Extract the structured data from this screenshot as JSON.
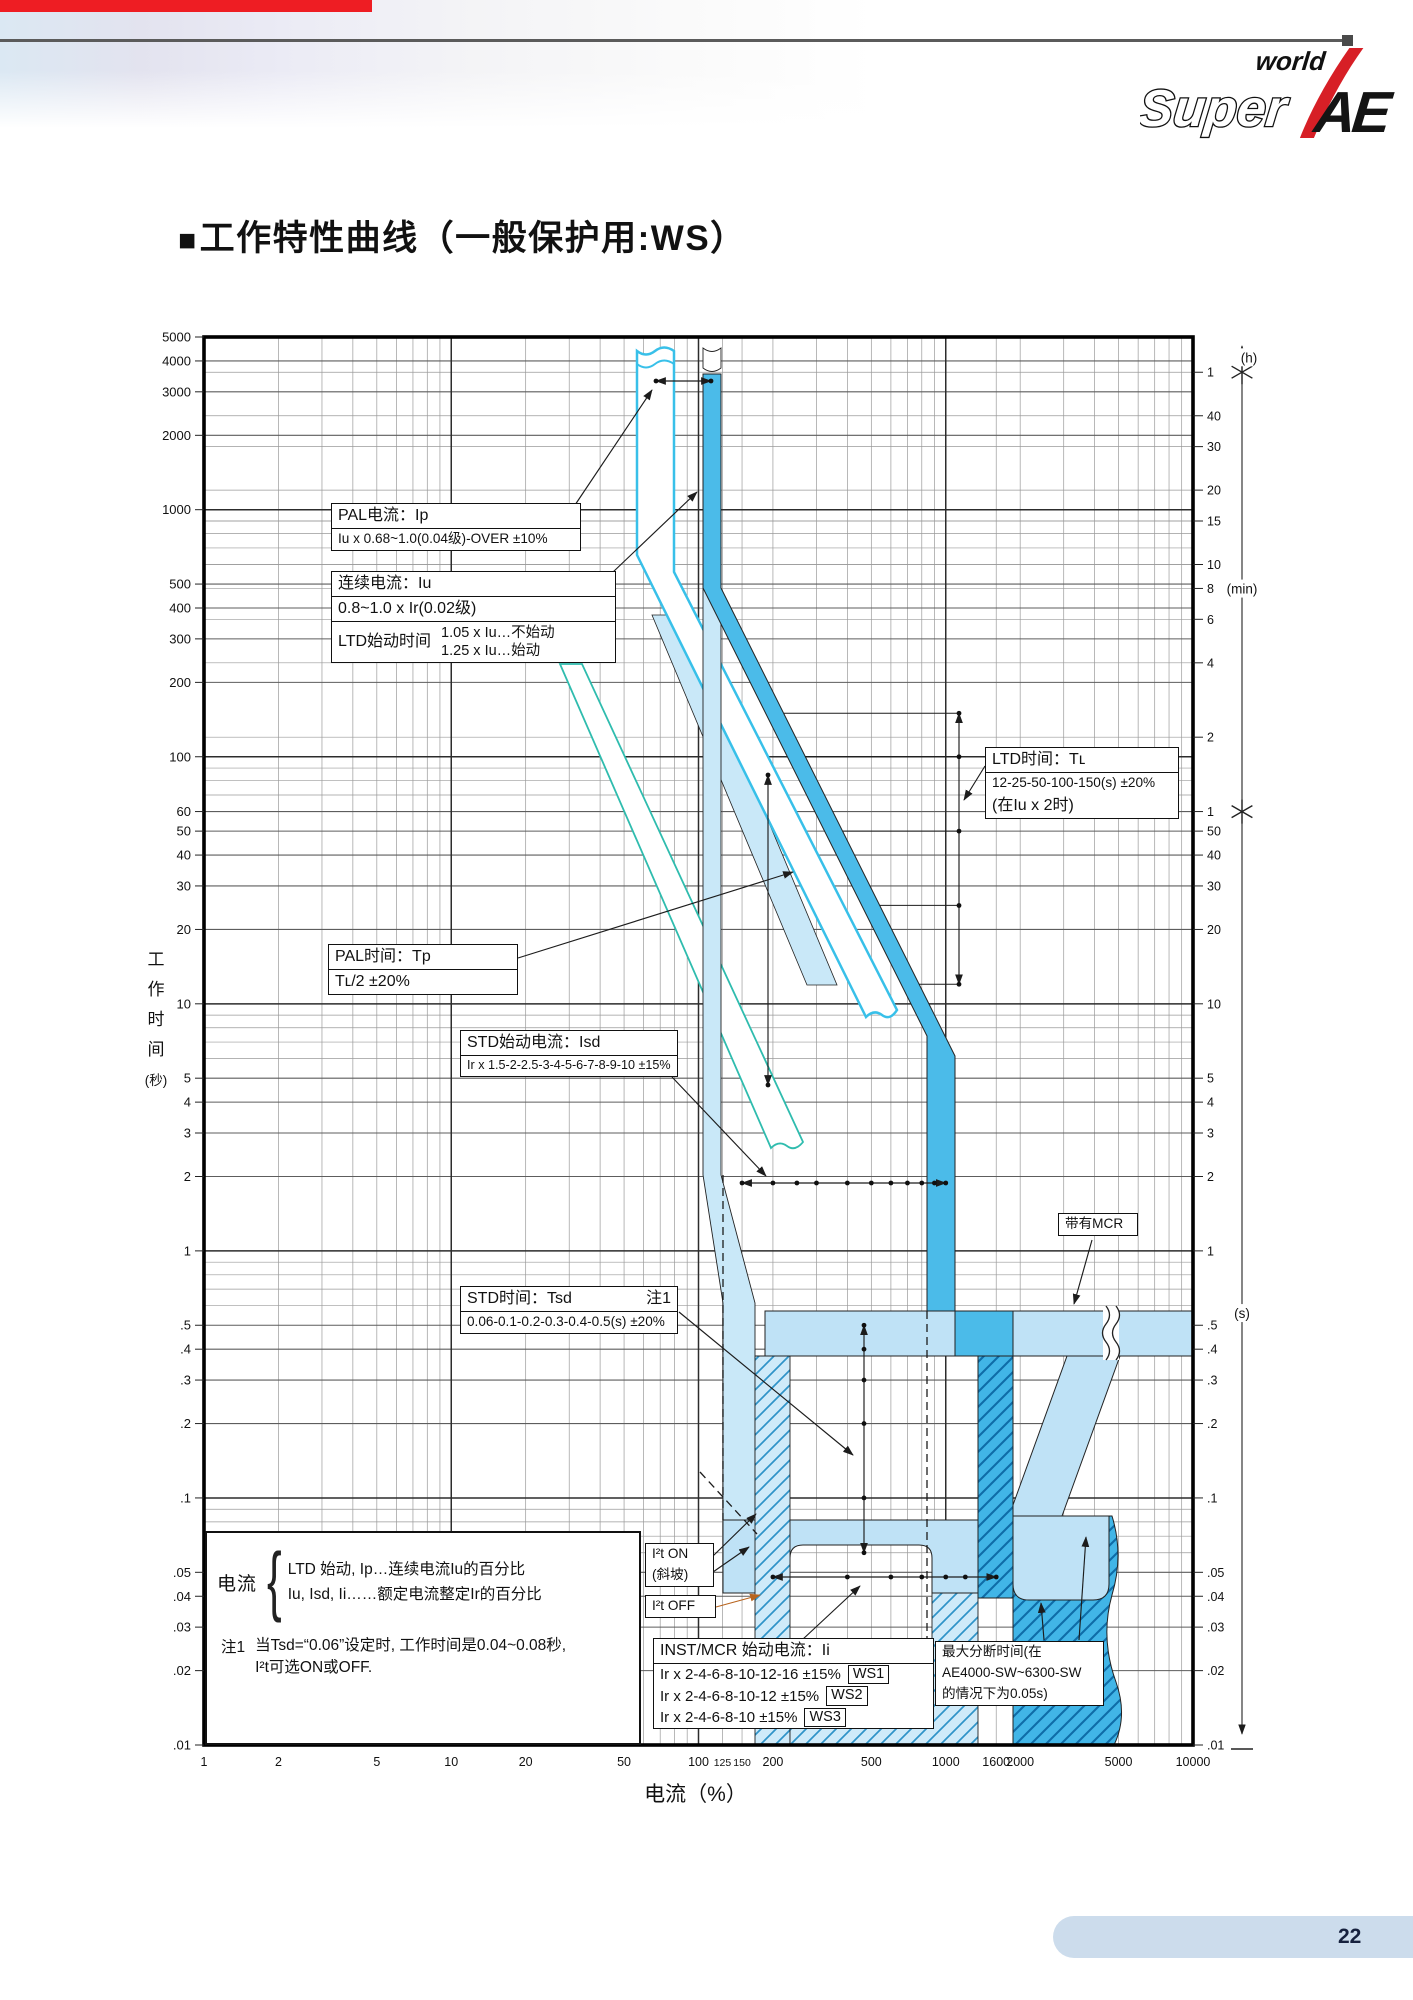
{
  "page": {
    "title_prefix": "■",
    "title": "工作特性曲线（一般保护用:WS）",
    "page_number": "22"
  },
  "logo": {
    "world": "world",
    "super": "Super",
    "ae": "AE",
    "accent_color": "#d71f26"
  },
  "header": {
    "red_bar_color": "#ee1d23",
    "rule_color": "#5b5b5b",
    "cap_color": "#4a4a4a"
  },
  "footer": {
    "bar_color": "#ccdcec"
  },
  "chart_data": {
    "type": "line",
    "subtype": "log-log protection trip bands",
    "xlabel": "电流（%）",
    "ylabel": "工作时间（秒）",
    "ylabel_vertical": [
      "工",
      "作",
      "时",
      "间",
      "(秒)"
    ],
    "x_range_pct": [
      1,
      10000
    ],
    "y_range_s": [
      0.01,
      5000
    ],
    "grid": "log-log, minor decades + minute lines",
    "x_tick_values": [
      1,
      2,
      5,
      10,
      20,
      50,
      100,
      125,
      150,
      200,
      500,
      1000,
      1600,
      2000,
      5000,
      10000
    ],
    "x_tick_labels": [
      "1",
      "2",
      "5",
      "10",
      "20",
      "50",
      "100",
      "125",
      "150",
      "200",
      "500",
      "1000",
      "1600",
      "2000",
      "5000",
      "10000"
    ],
    "x_small_labels": [
      "125",
      "150"
    ],
    "y_left_values": [
      5000,
      4000,
      3000,
      2000,
      1000,
      500,
      400,
      300,
      200,
      100,
      60,
      50,
      40,
      30,
      20,
      10,
      5,
      4,
      3,
      2,
      1,
      0.5,
      0.4,
      0.3,
      0.2,
      0.1,
      0.05,
      0.04,
      0.03,
      0.02,
      0.01
    ],
    "y_left_labels": [
      "5000",
      "4000",
      "3000",
      "2000",
      "1000",
      "500",
      "400",
      "300",
      "200",
      "100",
      "60",
      "50",
      "40",
      "30",
      "20",
      "10",
      "5",
      "4",
      "3",
      "2",
      "1",
      ".5",
      ".4",
      ".3",
      ".2",
      ".1",
      ".05",
      ".04",
      ".03",
      ".02",
      ".01"
    ],
    "right_axis": {
      "h_unit": "(h)",
      "h_ticks": [
        [
          "1",
          3600
        ]
      ],
      "min_unit": "(min)",
      "min_ticks": [
        [
          "40",
          2400
        ],
        [
          "30",
          1800
        ],
        [
          "20",
          1200
        ],
        [
          "15",
          900
        ],
        [
          "10",
          600
        ],
        [
          "8",
          480
        ],
        [
          "6",
          360
        ],
        [
          "4",
          240
        ],
        [
          "2",
          120
        ],
        [
          "1",
          60
        ]
      ],
      "s_unit": "(s)",
      "s_ticks": [
        [
          "50",
          50
        ],
        [
          "40",
          40
        ],
        [
          "30",
          30
        ],
        [
          "20",
          20
        ],
        [
          "10",
          10
        ],
        [
          "5",
          5
        ],
        [
          "4",
          4
        ],
        [
          "3",
          3
        ],
        [
          "2",
          2
        ],
        [
          "1",
          1
        ],
        [
          ".5",
          0.5
        ],
        [
          ".4",
          0.4
        ],
        [
          ".3",
          0.3
        ],
        [
          ".2",
          0.2
        ],
        [
          ".1",
          0.1
        ],
        [
          ".05",
          0.05
        ],
        [
          ".04",
          0.04
        ],
        [
          ".03",
          0.03
        ],
        [
          ".02",
          0.02
        ],
        [
          ".01",
          0.01
        ]
      ]
    },
    "settings": {
      "ltd_time_s": [
        150,
        100,
        50,
        25,
        12
      ],
      "std_time_s": [
        0.5,
        0.4,
        0.3,
        0.2,
        0.1,
        0.06
      ],
      "std_pickup_pct": [
        150,
        200,
        250,
        300,
        400,
        500,
        600,
        700,
        800,
        900,
        1000
      ],
      "inst_pickup_pct": [
        200,
        400,
        600,
        800,
        1000,
        1200,
        1600
      ]
    }
  },
  "annotations": {
    "boxes": [
      {
        "id": "pal-current",
        "x": 331,
        "y": 503,
        "w": 250,
        "rows": [
          {
            "t": "PAL电流：Ip",
            "div": true
          },
          {
            "t": "Iu x 0.68~1.0(0.04级)-OVER ±10%",
            "sm": true
          }
        ]
      },
      {
        "id": "continuous-current",
        "x": 331,
        "y": 571,
        "w": 285,
        "rows": [
          {
            "t": "连续电流：Iu",
            "div": true
          },
          {
            "t": "0.8~1.0 x Ir(0.02级)",
            "div": true
          },
          {
            "cols": {
              "left": "LTD始动时间",
              "right": [
                "1.05 x Iu…不始动",
                "1.25 x Iu…始动"
              ]
            }
          }
        ]
      },
      {
        "id": "ltd-time",
        "x": 985,
        "y": 747,
        "w": 194,
        "rows": [
          {
            "t": "LTD时间：Tʟ",
            "div": true
          },
          {
            "t": "12-25-50-100-150(s) ±20%",
            "sm": true
          },
          {
            "t": "(在Iu x 2时)",
            "sm": false
          }
        ]
      },
      {
        "id": "pal-time",
        "x": 328,
        "y": 944,
        "w": 190,
        "rows": [
          {
            "t": "PAL时间：Tp",
            "div": true
          },
          {
            "t": "Tʟ/2 ±20%"
          }
        ]
      },
      {
        "id": "std-pickup",
        "x": 460,
        "y": 1030,
        "w": 218,
        "rows": [
          {
            "t": "STD始动电流：Isd",
            "div": true
          },
          {
            "t": "Ir x 1.5-2-2.5-3-4-5-6-7-8-9-10 ±15%",
            "xs": true
          }
        ]
      },
      {
        "id": "std-time",
        "x": 460,
        "y": 1286,
        "w": 218,
        "rows": [
          {
            "t": "STD时间：Tsd",
            "right": "注1",
            "div": true
          },
          {
            "t": "0.06-0.1-0.2-0.3-0.4-0.5(s) ±20%",
            "sm": true
          }
        ]
      },
      {
        "id": "with-mcr",
        "x": 1058,
        "y": 1213,
        "w": 80,
        "rows": [
          {
            "t": "带有MCR",
            "sm": true
          }
        ]
      },
      {
        "id": "i2t-on",
        "x": 645,
        "y": 1543,
        "w": 69,
        "rows": [
          {
            "t": "I²t ON",
            "sm": true
          },
          {
            "t": "(斜坡)",
            "sm": true
          }
        ]
      },
      {
        "id": "i2t-off",
        "x": 645,
        "y": 1595,
        "w": 71,
        "rows": [
          {
            "t": "I²t OFF",
            "sm": true
          }
        ]
      },
      {
        "id": "inst-mcr-pickup",
        "x": 653,
        "y": 1638,
        "w": 281,
        "rows": [
          {
            "t": "INST/MCR 始动电流：Ii",
            "div": true
          },
          {
            "ws": "Ir x 2-4-6-8-10-12-16 ±15%",
            "badge": "WS1"
          },
          {
            "ws": "Ir x 2-4-6-8-10-12 ±15%",
            "badge": "WS2"
          },
          {
            "ws": "Ir x 2-4-6-8-10 ±15%",
            "badge": "WS3"
          }
        ]
      },
      {
        "id": "max-break-time",
        "x": 935,
        "y": 1641,
        "w": 169,
        "rows": [
          {
            "t": "最大分断时间(在",
            "sm": true
          },
          {
            "t": "AE4000-SW~6300-SW",
            "sm": true
          },
          {
            "t": "的情况下为0.05s)",
            "sm": true
          }
        ]
      }
    ]
  },
  "legend": {
    "x": 205,
    "y": 1531,
    "w": 436,
    "h": 214,
    "label": "电流",
    "brace": "{",
    "lines": [
      "LTD 始动, Ip…连续电流Iu的百分比",
      "Iu, Isd, Ii……额定电流整定Ir的百分比"
    ],
    "note_label": "注1",
    "note_lines": [
      "当Tsd=“0.06”设定时, 工作时间是0.04~0.08秒,",
      "I²t可选ON或OFF."
    ]
  },
  "geometry": {
    "plot": {
      "left": 204,
      "top": 337,
      "right": 1193,
      "bottom": 1745
    },
    "colors": {
      "blue": "#4bbbe9",
      "pale": "#bfe2f6",
      "pale2": "#c9e8f8",
      "cyan": "#38c0e9",
      "teal": "#2fbcae",
      "hatch_light_bg": "#cfeaf9",
      "hatch_light_ln": "#2f93c8",
      "hatch_dark_bg": "#41b5e7",
      "hatch_dark_ln": "#0e6ca8",
      "outline": "#1f1f1f"
    },
    "bands": [
      {
        "name": "iu-tolerance-diagonal",
        "d": "M652,615 L682,615 L837,985 L807,985 Z",
        "fill": "pale2",
        "stroke": "#222",
        "sw": 0.8
      },
      {
        "name": "pal-lower-band",
        "d": "M560,664 L582,664 L803,1142 Q795,1152 787,1146 Q779,1140 771,1148 Z",
        "fill": "#ffffff",
        "stroke": "teal",
        "sw": 1.8
      },
      {
        "name": "pal-band",
        "d": "M637,351 Q646,358 655,351 T674,351 L674,572 L897,1010 Q890,1021 882,1015 T866,1017 L637,555 Z",
        "fill": "#ffffff",
        "stroke": "cyan",
        "sw": 2.5
      },
      {
        "name": "pal-band-break-line",
        "d": "M637,364 Q646,371 655,364 T674,364",
        "fill": "none",
        "stroke": "cyan",
        "sw": 2
      },
      {
        "name": "iu-vertical-pale",
        "d": "M703,588 L721,588 L721,1175 L755,1303 L755,1520 L723,1520 L723,1303 L703,1175 Z",
        "fill": "pale2",
        "stroke": "#222",
        "sw": 0.9
      },
      {
        "name": "std-band",
        "d": "M765,1311 L1193,1311 L1193,1356 L765,1356 Z",
        "fill": "pale",
        "stroke": "#222",
        "sw": 1
      },
      {
        "name": "mcr-transition",
        "d": "M1067,1356 L1120,1356 L1062,1516 L1009,1516 Z",
        "fill": "pale",
        "stroke": "#222",
        "sw": 1
      },
      {
        "name": "mcr-bottom-dark",
        "d": "M1013,1516 L1112,1516 Q1124,1555 1112,1595 Q1100,1638 1116,1682 Q1128,1716 1114,1745 L1013,1745 Z",
        "fill": "hatchD",
        "stroke": "#222",
        "sw": 1
      },
      {
        "name": "inst-band-right",
        "d": "M1013,1516 L1109,1516 L1109,1584 Q1109,1600 1093,1600 L1029,1600 Q1013,1600 1013,1584 Z",
        "fill": "pale",
        "stroke": "#222",
        "sw": 1
      },
      {
        "name": "inst-band",
        "d": "M723,1520 L978,1520 L978,1593 L932,1593 L932,1558 Q932,1545 919,1545 L803,1545 Q790,1545 790,1558 L790,1593 L723,1593 Z",
        "fill": "pale",
        "stroke": "#222",
        "sw": 1
      },
      {
        "name": "hatch-col-light",
        "d": "M755,1356 L790,1356 L790,1745 L755,1745 Z",
        "fill": "hatchL",
        "stroke": "#222",
        "sw": 0.9
      },
      {
        "name": "hatch-bottom-light",
        "d": "M790,1656 L932,1656 L932,1593 L978,1593 L978,1745 L790,1745 Z",
        "fill": "hatchL",
        "stroke": "#222",
        "sw": 0.9
      },
      {
        "name": "hatch-col-dark",
        "d": "M978,1356 L1013,1356 L1013,1598 L978,1598 Z",
        "fill": "hatchD",
        "stroke": "#222",
        "sw": 1
      },
      {
        "name": "ltd-band",
        "d": "M703,374 L721,374 L721,588 L955,1056 L955,1311 L927,1311 L927,1036 L703,588 Z",
        "fill": "blue",
        "stroke": "#222",
        "sw": 1
      },
      {
        "name": "ltd-band-cap",
        "d": "M703,348 Q712,355 721,348 L721,368 Q712,375 703,368 Z",
        "fill": "#ffffff",
        "stroke": "#222",
        "sw": 0.9
      },
      {
        "name": "ltd-std-cross",
        "d": "M955,1311 L1013,1311 L1013,1356 L955,1356 Z",
        "fill": "blue",
        "stroke": "#222",
        "sw": 1
      }
    ],
    "std_band_break": {
      "x": 1111,
      "y1": 1306,
      "y2": 1360
    },
    "dashes": [
      [
        723,
        1175,
        723,
        1520
      ],
      [
        927,
        1311,
        927,
        1658
      ],
      [
        700,
        1472,
        757,
        1534
      ]
    ],
    "hlines": [
      [
        784,
        959,
        713.3
      ],
      [
        805,
        959,
        756.8
      ],
      [
        843,
        959,
        831.1
      ],
      [
        880,
        959,
        905.4
      ],
      [
        919,
        959,
        984.3
      ]
    ],
    "arrows": [
      {
        "name": "pickup-span",
        "x1": 656,
        "y1": 381,
        "x2": 711,
        "y2": 381,
        "heads": "both",
        "endDots": true
      },
      {
        "name": "pal-current-leader",
        "x1": 575,
        "y1": 505,
        "x2": 652,
        "y2": 390,
        "heads": "end"
      },
      {
        "name": "continuous-leader",
        "x1": 612,
        "y1": 573,
        "x2": 697,
        "y2": 492,
        "heads": "end"
      },
      {
        "name": "ltd-time-dim",
        "x": 959,
        "dotsY_s": [
          150,
          100,
          50,
          25,
          12
        ],
        "heads": "both"
      },
      {
        "name": "ltd-box-leader",
        "x1": 985,
        "y1": 766,
        "x2": 964,
        "y2": 800,
        "heads": "end"
      },
      {
        "name": "pal-time-leader",
        "x1": 518,
        "y1": 958,
        "x2": 793,
        "y2": 872,
        "heads": "end"
      },
      {
        "name": "pal-time-dim",
        "x1": 768,
        "y1": 775,
        "x2": 768,
        "y2": 1085,
        "heads": "both",
        "endDots": true
      },
      {
        "name": "std-pickup-dim",
        "y": 1183,
        "dotsX_pct": [
          150,
          200,
          250,
          300,
          400,
          500,
          600,
          700,
          800,
          900,
          1000
        ],
        "heads": "both"
      },
      {
        "name": "std-pickup-leader",
        "x1": 672,
        "y1": 1077,
        "x2": 766,
        "y2": 1176,
        "heads": "end"
      },
      {
        "name": "std-time-dim",
        "x": 864,
        "dotsY_s": [
          0.5,
          0.4,
          0.3,
          0.2,
          0.1,
          0.06
        ],
        "heads": "both"
      },
      {
        "name": "std-time-leader",
        "x1": 679,
        "y1": 1312,
        "x2": 853,
        "y2": 1455,
        "heads": "end"
      },
      {
        "name": "i2t-on-leader1",
        "x1": 713,
        "y1": 1556,
        "x2": 756,
        "y2": 1514,
        "heads": "end"
      },
      {
        "name": "i2t-on-leader2",
        "x1": 713,
        "y1": 1572,
        "x2": 749,
        "y2": 1547,
        "heads": "end"
      },
      {
        "name": "i2t-off-leader",
        "x1": 716,
        "y1": 1607,
        "x2": 760,
        "y2": 1595,
        "heads": "end",
        "color": "#b8641e"
      },
      {
        "name": "inst-pickup-dim",
        "y": 1577,
        "dotsX_pct": [
          200,
          400,
          600,
          800,
          1000,
          1200,
          1600
        ],
        "heads": "both"
      },
      {
        "name": "inst-box-leader",
        "x1": 802,
        "y1": 1640,
        "x2": 860,
        "y2": 1586,
        "heads": "end"
      },
      {
        "name": "mcr-leader",
        "x1": 1092,
        "y1": 1240,
        "x2": 1074,
        "y2": 1304,
        "heads": "end"
      },
      {
        "name": "break-time-leader1",
        "x1": 1044,
        "y1": 1640,
        "x2": 1041,
        "y2": 1603,
        "heads": "end"
      },
      {
        "name": "break-time-leader2",
        "x1": 1079,
        "y1": 1640,
        "x2": 1086,
        "y2": 1537,
        "heads": "end"
      }
    ],
    "ruler": {
      "x": 1242,
      "y1": 346,
      "y2": 1734,
      "stars_s": [
        3600,
        60
      ],
      "foot_y": 1749
    }
  }
}
